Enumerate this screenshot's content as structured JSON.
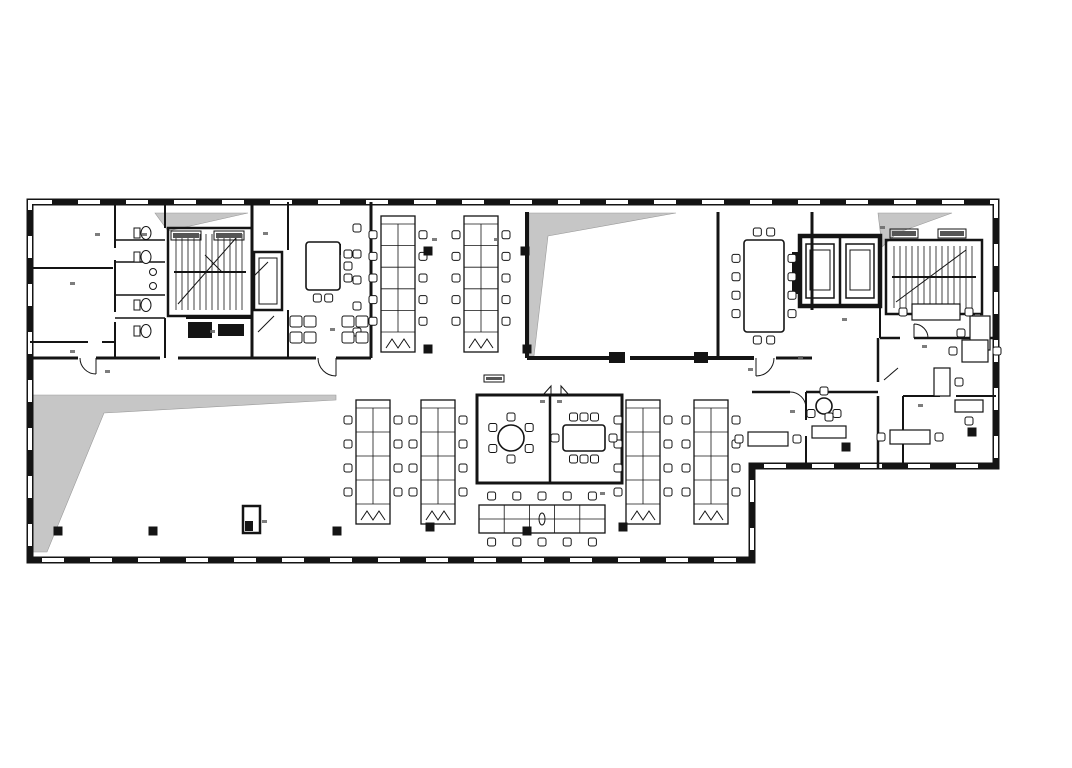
{
  "meta": {
    "title": "office-floor-plan",
    "ink": "#141414",
    "void_gray": "#c6c6c6",
    "paper": "#ffffff"
  },
  "plan": {
    "outline": {
      "d": "M30,202 H996 V466 H752 V560 H30 Z",
      "w": 7,
      "dash": "22 26"
    },
    "grayZones": [
      {
        "pts": "529,213 676,213 548,236 534,356 529,356"
      },
      {
        "pts": "33,395 336,395 336,400 104,413 47,552 33,552"
      },
      {
        "pts": "878,213 952,213 897,233 882,247"
      },
      {
        "pts": "155,213 248,213 168,231"
      }
    ],
    "walls": [
      [
        252,
        202,
        252,
        358,
        3
      ],
      [
        115,
        202,
        115,
        248,
        2
      ],
      [
        115,
        260,
        115,
        312,
        2
      ],
      [
        115,
        322,
        115,
        358,
        2
      ],
      [
        30,
        268,
        113,
        268,
        2
      ],
      [
        30,
        342,
        88,
        342,
        2
      ],
      [
        102,
        342,
        115,
        342,
        2
      ],
      [
        115,
        240,
        165,
        240,
        1.5
      ],
      [
        115,
        262,
        165,
        262,
        1.5
      ],
      [
        115,
        295,
        165,
        295,
        1.5
      ],
      [
        115,
        318,
        165,
        318,
        1.5
      ],
      [
        165,
        202,
        165,
        228,
        2
      ],
      [
        165,
        318,
        165,
        358,
        2
      ],
      [
        30,
        358,
        78,
        358,
        3
      ],
      [
        96,
        358,
        160,
        358,
        3
      ],
      [
        178,
        358,
        252,
        358,
        3
      ],
      [
        186,
        318,
        252,
        318,
        2
      ],
      [
        288,
        202,
        288,
        250,
        2
      ],
      [
        288,
        310,
        288,
        358,
        2
      ],
      [
        371,
        202,
        371,
        358,
        3
      ],
      [
        252,
        358,
        316,
        358,
        3
      ],
      [
        336,
        358,
        371,
        358,
        3
      ],
      [
        527,
        212,
        527,
        358,
        4
      ],
      [
        527,
        358,
        609,
        358,
        4
      ],
      [
        630,
        358,
        754,
        358,
        4
      ],
      [
        776,
        358,
        812,
        358,
        3
      ],
      [
        718,
        212,
        718,
        358,
        3
      ],
      [
        812,
        212,
        812,
        310,
        3
      ],
      [
        840,
        236,
        840,
        306,
        2.5
      ],
      [
        880,
        306,
        880,
        338,
        2
      ],
      [
        880,
        338,
        900,
        338,
        2.5
      ],
      [
        914,
        338,
        996,
        338,
        2.5
      ],
      [
        878,
        338,
        878,
        382,
        2.5
      ],
      [
        878,
        396,
        878,
        468,
        2.5
      ],
      [
        903,
        396,
        940,
        396,
        2
      ],
      [
        956,
        396,
        996,
        396,
        2
      ],
      [
        903,
        396,
        903,
        430,
        2
      ],
      [
        903,
        444,
        903,
        468,
        2
      ],
      [
        752,
        392,
        790,
        392,
        2.5
      ],
      [
        806,
        392,
        878,
        392,
        2.5
      ],
      [
        806,
        392,
        806,
        420,
        2
      ],
      [
        806,
        436,
        806,
        466,
        2
      ],
      [
        550,
        395,
        550,
        483,
        2.5
      ]
    ],
    "rects": [
      [
        800,
        236,
        80,
        70,
        4.5
      ],
      [
        806,
        244,
        28,
        54,
        1.5
      ],
      [
        846,
        244,
        28,
        54,
        1.5
      ],
      [
        810,
        250,
        20,
        40,
        1
      ],
      [
        850,
        250,
        20,
        40,
        1
      ],
      [
        254,
        252,
        28,
        58,
        2.5
      ],
      [
        259,
        258,
        18,
        46,
        1
      ],
      [
        477,
        395,
        145,
        88,
        3
      ],
      [
        243,
        506,
        17,
        27,
        2.5
      ]
    ],
    "fills": [
      [
        188,
        322,
        24,
        16
      ],
      [
        218,
        324,
        26,
        12
      ],
      [
        792,
        252,
        8,
        42
      ],
      [
        330,
        244,
        11,
        11
      ],
      [
        245,
        521,
        8,
        10
      ],
      [
        609,
        352,
        16,
        11
      ],
      [
        694,
        352,
        14,
        11
      ]
    ],
    "columns": [
      [
        428,
        251
      ],
      [
        525,
        251
      ],
      [
        428,
        349
      ],
      [
        527,
        349
      ],
      [
        58,
        531
      ],
      [
        153,
        531
      ],
      [
        337,
        531
      ],
      [
        430,
        527
      ],
      [
        527,
        531
      ],
      [
        623,
        527
      ],
      [
        846,
        447
      ],
      [
        972,
        432
      ]
    ],
    "stairs": [
      {
        "x": 168,
        "y": 228,
        "w": 84,
        "h": 88
      },
      {
        "x": 886,
        "y": 240,
        "w": 96,
        "h": 74
      }
    ],
    "elevLabels": [
      [
        171,
        231,
        30,
        9
      ],
      [
        214,
        231,
        30,
        9
      ],
      [
        890,
        229,
        28,
        9
      ],
      [
        938,
        229,
        28,
        9
      ],
      [
        484,
        375,
        20,
        7
      ]
    ],
    "benches": [
      {
        "x": 381,
        "y": 216,
        "w": 34,
        "h": 136,
        "n": 5
      },
      {
        "x": 464,
        "y": 216,
        "w": 34,
        "h": 136,
        "n": 5
      },
      {
        "x": 356,
        "y": 400,
        "w": 34,
        "h": 124,
        "n": 4
      },
      {
        "x": 421,
        "y": 400,
        "w": 34,
        "h": 124,
        "n": 4
      },
      {
        "x": 626,
        "y": 400,
        "w": 34,
        "h": 124,
        "n": 4
      },
      {
        "x": 694,
        "y": 400,
        "w": 34,
        "h": 124,
        "n": 4
      }
    ],
    "hbench": {
      "x": 479,
      "y": 505,
      "w": 126,
      "h": 28,
      "n": 5
    },
    "roundTables": [
      {
        "cx": 511,
        "cy": 438,
        "r": 13,
        "n": 6,
        "cr": 21
      },
      {
        "cx": 824,
        "cy": 406,
        "r": 8,
        "n": 3,
        "cr": 15
      }
    ],
    "rectTables": [
      {
        "x": 563,
        "y": 425,
        "w": 42,
        "h": 26,
        "t": 3,
        "b": 3,
        "l": 1,
        "r": 1
      },
      {
        "x": 744,
        "y": 240,
        "w": 40,
        "h": 92,
        "t": 2,
        "b": 2,
        "l": 4,
        "r": 4
      },
      {
        "x": 306,
        "y": 242,
        "w": 34,
        "h": 48,
        "t": 0,
        "b": 2,
        "l": 0,
        "r": 3
      }
    ],
    "lounges": [
      [
        357,
        228
      ],
      [
        357,
        254
      ],
      [
        357,
        280
      ],
      [
        357,
        306
      ],
      [
        357,
        332
      ]
    ],
    "armClusters": [
      [
        290,
        316
      ],
      [
        342,
        316
      ]
    ],
    "toilets": [
      [
        134,
        226
      ],
      [
        134,
        250
      ],
      [
        134,
        298
      ],
      [
        134,
        324
      ]
    ],
    "sinks": [
      [
        153,
        272
      ],
      [
        153,
        286
      ]
    ],
    "officeDesks": [
      {
        "x": 912,
        "y": 304,
        "w": 48,
        "h": 16,
        "ch": [
          [
            -9,
            8
          ],
          [
            57,
            8
          ]
        ]
      },
      {
        "x": 970,
        "y": 316,
        "w": 20,
        "h": 34,
        "ch": [
          [
            -9,
            17
          ]
        ]
      },
      {
        "x": 962,
        "y": 340,
        "w": 26,
        "h": 22,
        "ch": [
          [
            -9,
            11
          ],
          [
            35,
            11
          ]
        ]
      },
      {
        "x": 934,
        "y": 368,
        "w": 16,
        "h": 28,
        "ch": [
          [
            25,
            14
          ]
        ]
      },
      {
        "x": 890,
        "y": 430,
        "w": 40,
        "h": 14,
        "ch": [
          [
            -9,
            7
          ],
          [
            49,
            7
          ]
        ]
      },
      {
        "x": 955,
        "y": 400,
        "w": 28,
        "h": 12,
        "ch": [
          [
            14,
            21
          ]
        ]
      },
      {
        "x": 748,
        "y": 432,
        "w": 40,
        "h": 14,
        "ch": [
          [
            -9,
            7
          ],
          [
            49,
            7
          ]
        ]
      },
      {
        "x": 812,
        "y": 426,
        "w": 34,
        "h": 12,
        "ch": [
          [
            17,
            -9
          ]
        ]
      }
    ],
    "doors": [
      "M756,358 L756,376 M774,358 A18,18 0 0 1 756,376",
      "M336,358 L336,376 M318,358 A18,18 0 0 0 336,376",
      "M96,358 L96,374 M80,358 A16,16 0 0 0 96,374",
      "M914,338 L914,324 M928,338 A14,14 0 0 0 914,324",
      "M806,392 L806,408 M790,392 A16,16 0 0 1 806,408"
    ],
    "doorLeafPolys": [
      "543,395 551,386 551,395",
      "569,395 561,386 561,395"
    ],
    "thinLines": [
      [
        205,
        255,
        222,
        272
      ],
      [
        252,
        278,
        268,
        262
      ],
      [
        258,
        332,
        274,
        316
      ],
      [
        884,
        380,
        898,
        368
      ]
    ],
    "roomMarks": [
      [
        95,
        233
      ],
      [
        142,
        233
      ],
      [
        70,
        282
      ],
      [
        70,
        350
      ],
      [
        105,
        370
      ],
      [
        210,
        330
      ],
      [
        263,
        232
      ],
      [
        330,
        328
      ],
      [
        262,
        520
      ],
      [
        432,
        238
      ],
      [
        494,
        238
      ],
      [
        540,
        400
      ],
      [
        557,
        400
      ],
      [
        600,
        492
      ],
      [
        798,
        356
      ],
      [
        842,
        318
      ],
      [
        922,
        345
      ],
      [
        975,
        314
      ],
      [
        790,
        410
      ],
      [
        918,
        404
      ],
      [
        748,
        368
      ],
      [
        880,
        226
      ]
    ]
  }
}
